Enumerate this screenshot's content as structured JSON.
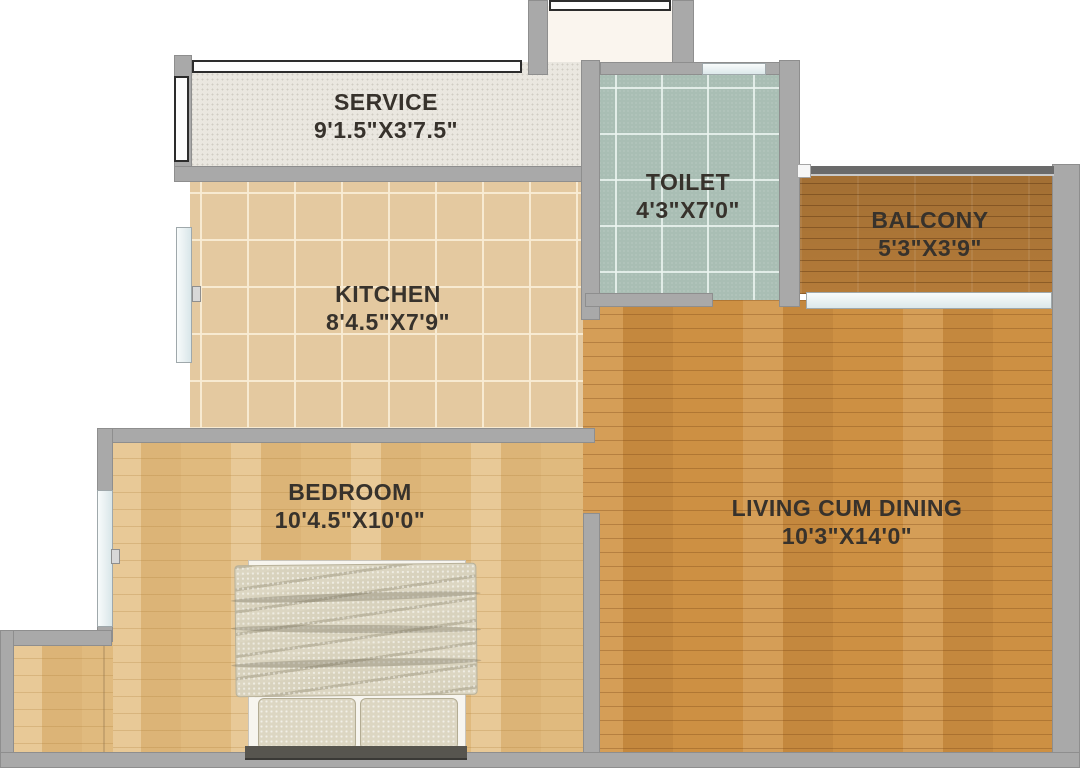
{
  "rooms": [
    {
      "id": "service",
      "name": "SERVICE",
      "size": "9'1.5\"X3'7.5\""
    },
    {
      "id": "toilet",
      "name": "TOILET",
      "size": "4'3\"X7'0\""
    },
    {
      "id": "balcony",
      "name": "BALCONY",
      "size": "5'3\"X3'9\""
    },
    {
      "id": "kitchen",
      "name": "KITCHEN",
      "size": "8'4.5\"X7'9\""
    },
    {
      "id": "bedroom",
      "name": "BEDROOM",
      "size": "10'4.5\"X10'0\""
    },
    {
      "id": "living",
      "name": "LIVING CUM DINING",
      "size": "10'3\"X14'0\""
    }
  ],
  "colors": {
    "wall": "#a9a9a9",
    "service_floor": "#eae7e0",
    "toilet_floor": "#a9beb4",
    "kitchen_floor": "#e4c9a0",
    "balcony_floor": "#b47b39",
    "bedroom_floor": "#e0ba7e",
    "living_floor": "#cd9043",
    "label_text": "#37322c",
    "background": "#ffffff"
  }
}
